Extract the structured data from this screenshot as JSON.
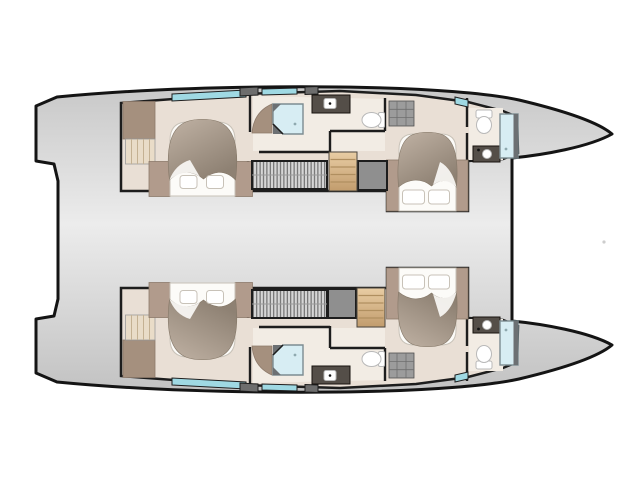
{
  "document": {
    "kind": "yacht-floor-plan",
    "vessel_type": "catamaran",
    "view": "top-down interior deck plan, bow pointing right"
  },
  "plan": {
    "hulls": [
      {
        "id": "top-hull",
        "rooms": [
          "aft-cabin",
          "mid-head",
          "companionway",
          "forward-cabin",
          "forward-head"
        ]
      },
      {
        "id": "bottom-hull",
        "rooms": [
          "aft-cabin",
          "mid-head",
          "companionway",
          "forward-cabin",
          "forward-head"
        ]
      }
    ],
    "fixtures_per_hull": {
      "double-berths": 2,
      "showers": 2,
      "toilets": 2,
      "sink-vanities": 2,
      "wardrobes": 3,
      "stair-flights": 2,
      "hull-windows": 3,
      "deck-hatches": 2,
      "slatted-lockers": 1
    },
    "bridge_deck": "connects both hulls aft of the forward beam line"
  },
  "colors": {
    "background": "#ffffff",
    "outline": "#141414",
    "wall": "#1d1d1d",
    "hull_top": "#c8c8c8",
    "hull_mid": "#ececec",
    "hull_bottom": "#c2c2c2",
    "floor": "#e9dfd5",
    "floor_light": "#f2ece4",
    "wood": "#b19b8c",
    "wood_dark": "#a5907e",
    "duvet_light": "#c0b2a4",
    "duvet_dark": "#8e8173",
    "linen": "#fcfbf8",
    "window_teal": "#9fd9e3",
    "shower_glass": "#d7edf3",
    "shower_frame": "#7c8c91",
    "stairs_light": "#e9cda4",
    "stairs_dark": "#c29c6d",
    "stair_tread": "#b08f60",
    "hatch_fill": "#d6d6d6",
    "hatch_stripe": "#5c5c5c",
    "block_gray": "#8f8f8f",
    "vanity": "#544e48",
    "fixture": "#ffffff",
    "fixture_stroke": "#c8c2b8",
    "stray": "#cdcdcd"
  }
}
